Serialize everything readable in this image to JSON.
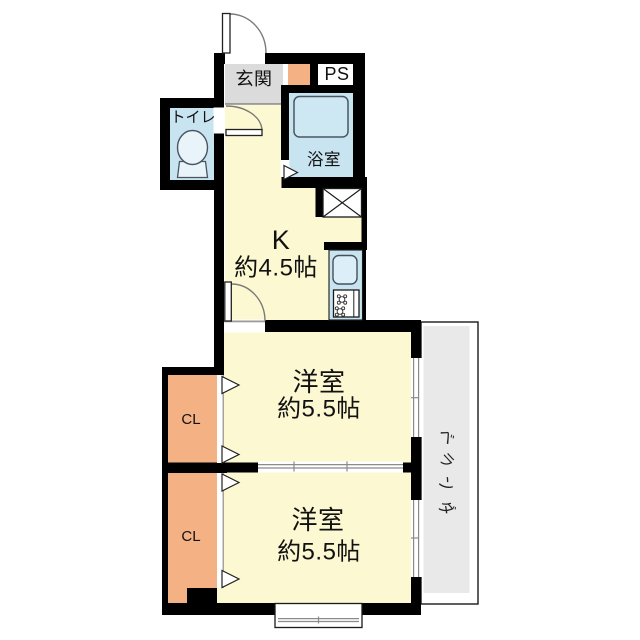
{
  "colors": {
    "wall": "#000000",
    "floor": "#FBF8D2",
    "water": "#C7E4F0",
    "fixture": "#DCEFF8",
    "closet": "#F4B183",
    "genkan": "#DBDBDB",
    "veranda": "#E9E9E9"
  },
  "plan": {
    "genkan": {
      "label": "玄関"
    },
    "ps": {
      "label": "PS"
    },
    "toilet": {
      "label": "トイレ"
    },
    "bath": {
      "label": "浴室"
    },
    "kitchen": {
      "name": "K",
      "size": "約4.5帖"
    },
    "room_upper": {
      "name": "洋室",
      "size": "約5.5帖"
    },
    "room_lower": {
      "name": "洋室",
      "size": "約5.5帖"
    },
    "closet_upper": {
      "label": "CL"
    },
    "closet_lower": {
      "label": "CL"
    },
    "veranda": {
      "label": "ベランダ",
      "chars": [
        "ベ",
        "ラ",
        "ン",
        "ダ"
      ]
    }
  }
}
